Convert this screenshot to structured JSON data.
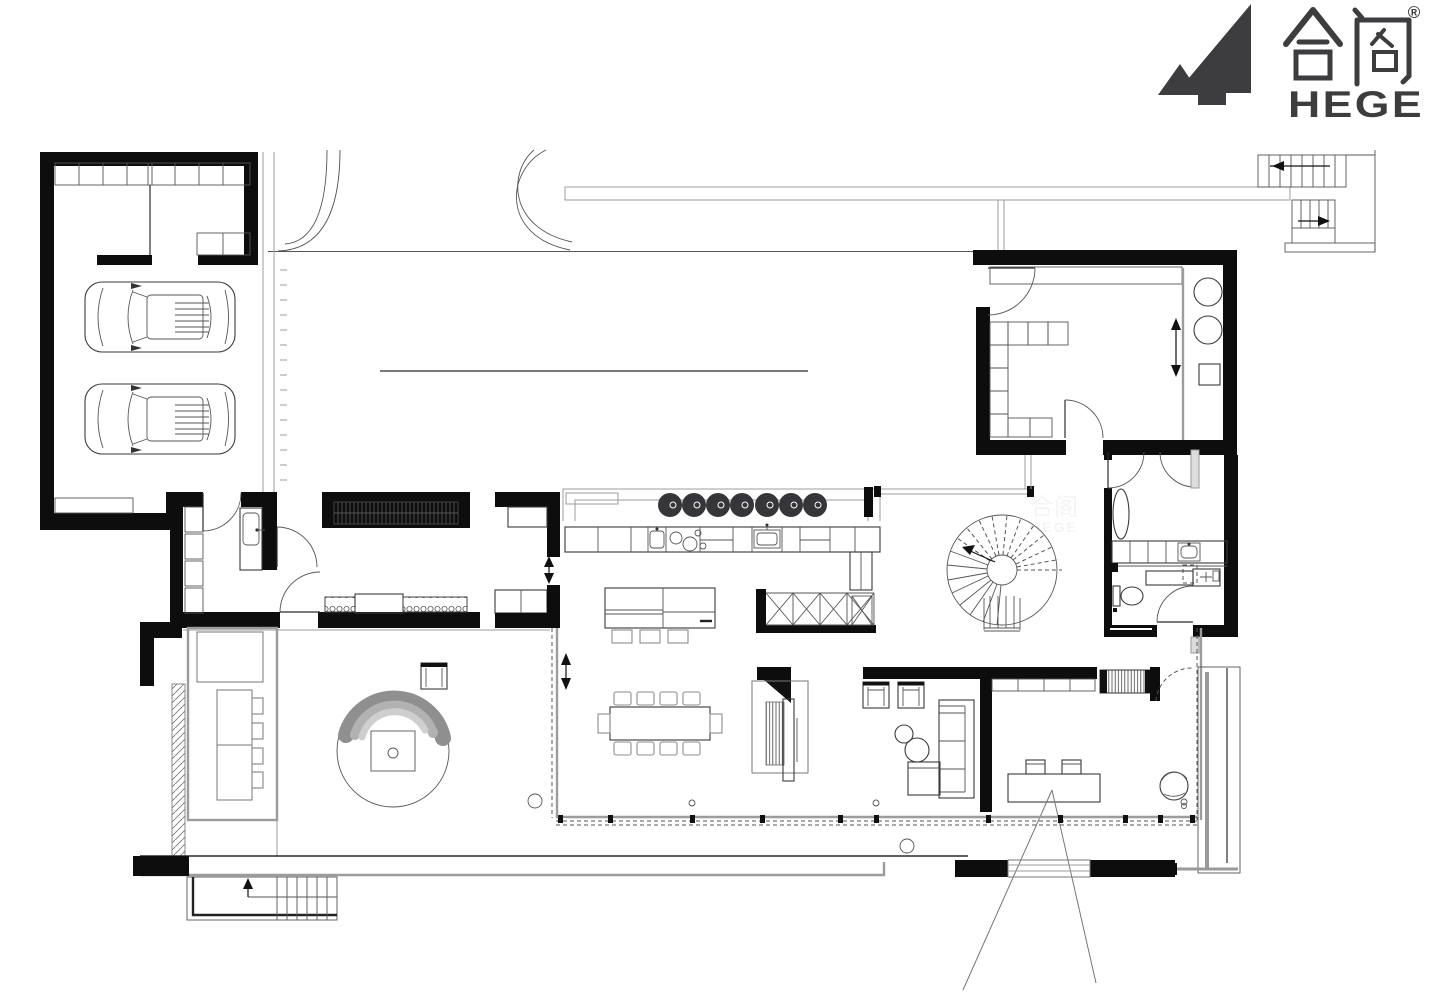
{
  "logo": {
    "cjk": "合阁",
    "latin": "HEGE",
    "registered": "®",
    "mark": "mountain-h-logo",
    "color": "#3d3d40"
  },
  "colors": {
    "paper": "#ffffff",
    "wall": "#0d0d0d",
    "ink": "#1a1a1a",
    "light_gray": "#9c9c9c",
    "mid_gray": "#777777",
    "logo": "#3d3d40",
    "canopy_outer": "#8f8f8f",
    "canopy_mid": "#b2b2b2",
    "canopy_inner": "#cfcfcf",
    "stool": "#35353a"
  },
  "plan": {
    "kind": "architectural floor plan, black-and-white line drawing",
    "depicted": {
      "garage": {
        "cars": 2,
        "storage_cabinet_cells": 8,
        "workbench": 1
      },
      "driveway": {
        "curved_paths": 2,
        "edge_lines": true
      },
      "exterior_stairs": {
        "flights": 2,
        "direction_arrows": 2
      },
      "utility_room": {
        "round_appliances": 2,
        "counter_cells": 9,
        "sliding_door_arrow": 1,
        "door_arcs": 2
      },
      "kitchen": {
        "bar_stools": 7,
        "island_stools": 3,
        "cooktop_burners": 4,
        "sinks": 2,
        "x_brace_cells": 5
      },
      "spiral_staircase": {
        "solid_treads": 8,
        "dashed_radials": 10
      },
      "bathroom": {
        "tub": 1,
        "vanity_sinks": 2,
        "toilet": 1,
        "sliding_doors": 2
      },
      "dining_area": {
        "table": 1,
        "chairs": 10,
        "floor_outlets": 2
      },
      "living_area": {
        "armchairs": 2,
        "sofa_with_chaise": 1,
        "round_tables": 2,
        "media_fireplace_wall": 1
      },
      "study": {
        "desk": 1,
        "desk_chairs": 2,
        "lounge_chair": 1,
        "bookshelf": 1,
        "leader_lines": 2
      },
      "courtyard": {
        "tree_with_planter": 1,
        "outdoor_table": 1,
        "outdoor_chairs": 4,
        "side_chair": 1,
        "hatched_deck_strip": 1
      },
      "terrace": {
        "glass_wall_dashed": true,
        "steps_with_arrow": 1,
        "downlight_circles": 5
      },
      "wardrobes": {
        "hatched_closets": 2,
        "hanger_closets": 2
      },
      "entry": {
        "mudroom_sink": 1,
        "door_arcs": 4
      }
    }
  }
}
